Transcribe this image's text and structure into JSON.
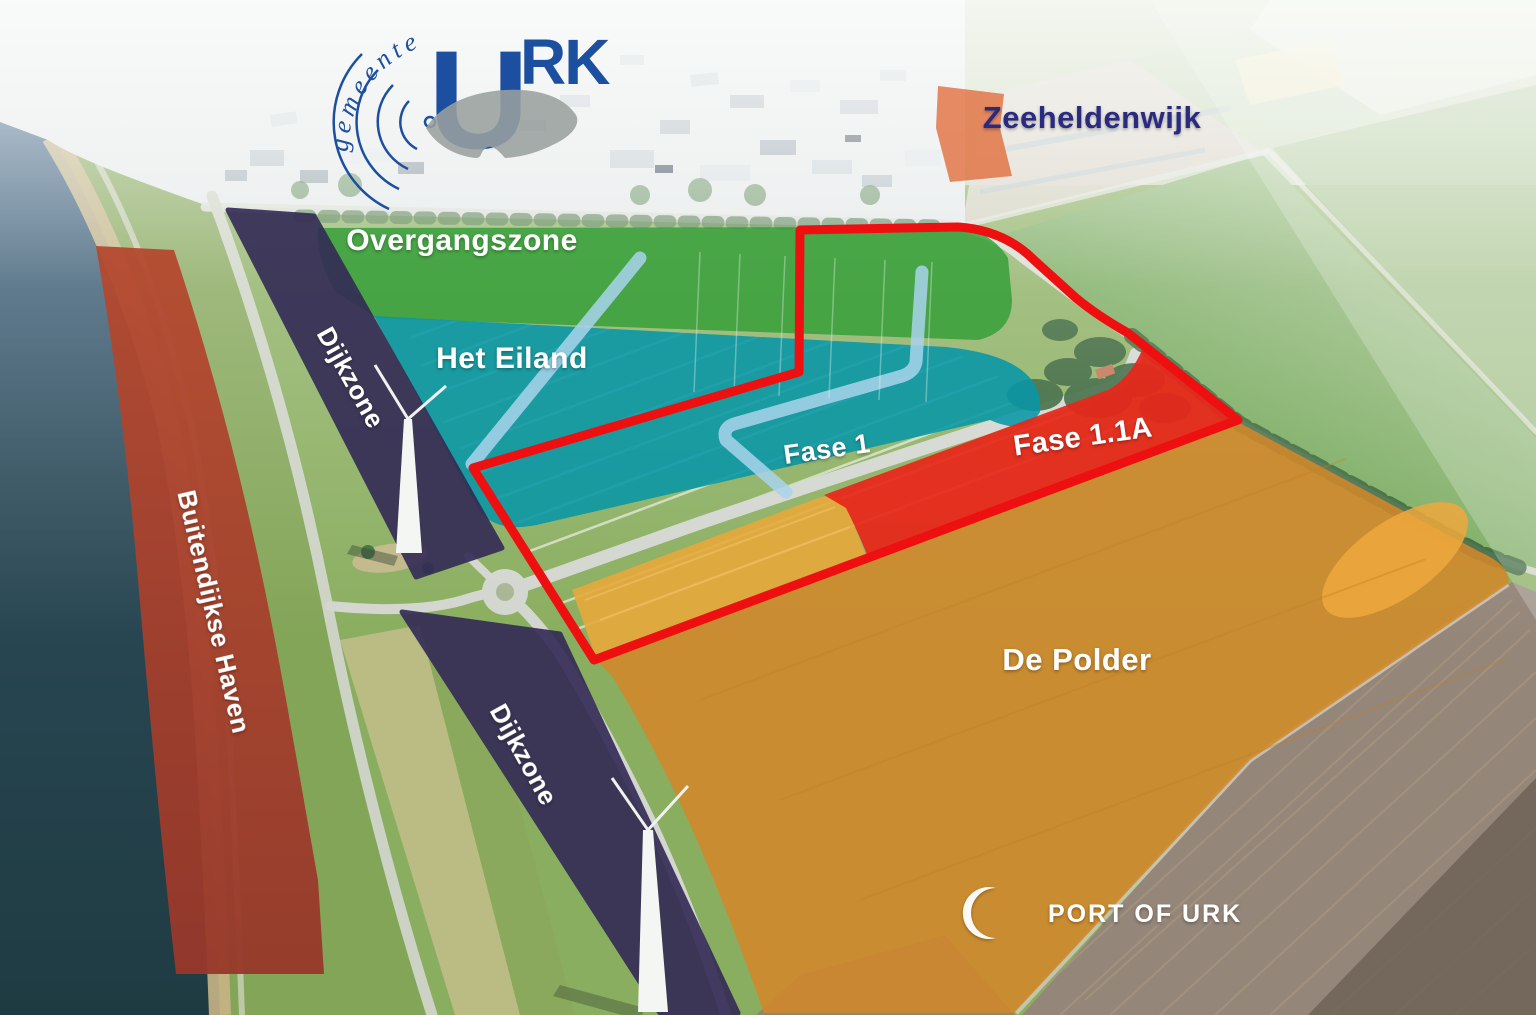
{
  "branding": {
    "gemeente_logo": {
      "arc_text": "gemeente",
      "name_initial": "U",
      "name_rest": "RK",
      "color": "#1d4fa0",
      "island_color": "#9aa09e"
    },
    "port_logo": {
      "text": "PORT OF URK",
      "color": "#ffffff"
    }
  },
  "zones": {
    "zeeheldenwijk": {
      "label": "Zeeheldenwijk",
      "text_color": "#2b2b7e",
      "area_color": "#e06532"
    },
    "overgangszone": {
      "label": "Overgangszone",
      "color": "#2f9e35"
    },
    "het_eiland": {
      "label": "Het Eiland",
      "color": "#0796a6"
    },
    "fase_1": {
      "label": "Fase 1"
    },
    "fase_1_1a": {
      "label": "Fase 1.1A",
      "color": "#e92519"
    },
    "dijkzone_north": {
      "label": "Dijkzone",
      "color": "#332a55"
    },
    "dijkzone_south": {
      "label": "Dijkzone",
      "color": "#332a55"
    },
    "buitendijkse_haven": {
      "label": "Buitendijkse Haven",
      "color": "#a8422e"
    },
    "de_polder": {
      "label": "De Polder",
      "color": "#d2882b"
    },
    "fase_1_yellow_area_color": "#e7a93b"
  },
  "outline": {
    "color": "#ee1010"
  },
  "waterway": {
    "color": "#a9d4ec"
  }
}
